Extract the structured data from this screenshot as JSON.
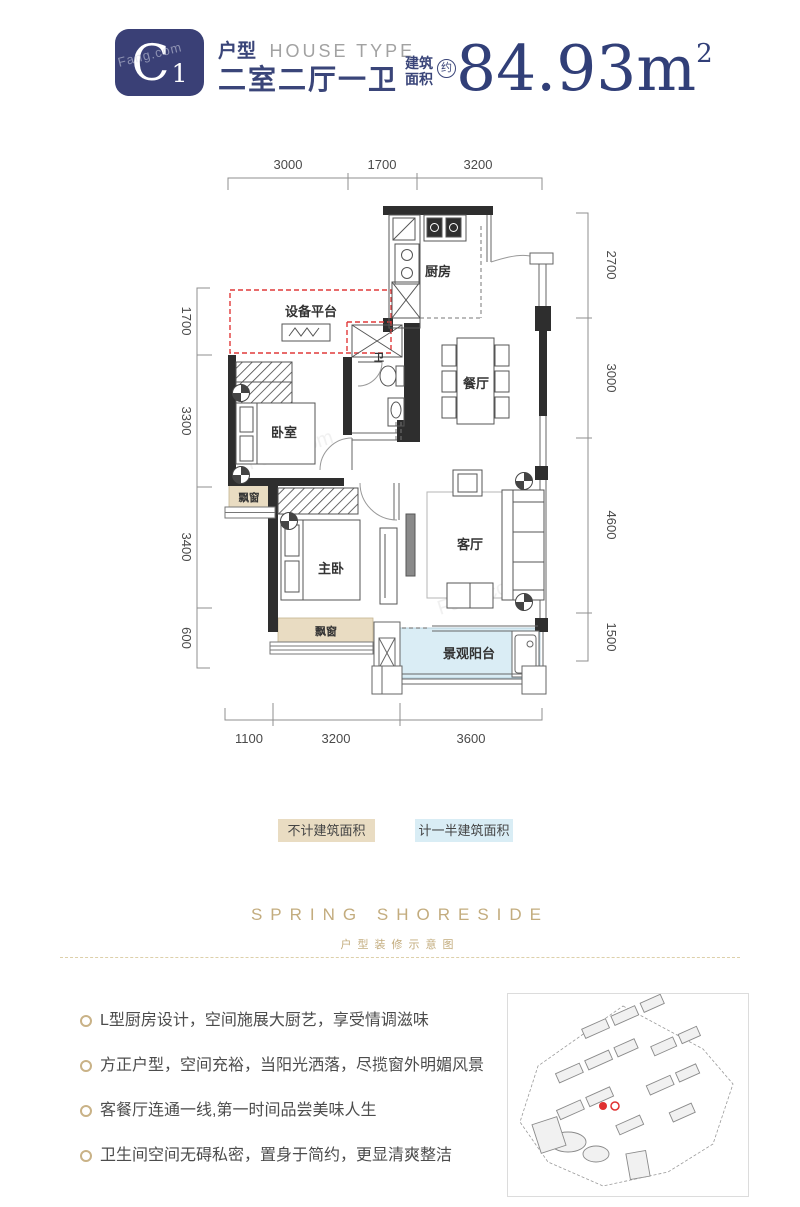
{
  "watermark": "Fang.com",
  "header": {
    "unit_letter": "C",
    "unit_number": "1",
    "label_cn": "户型",
    "label_en": "HOUSE TYPE",
    "layout_name": "二室二厅一卫",
    "area_label_1": "建筑",
    "area_label_2": "面积",
    "area_circle": "约",
    "area_value": "84.93m",
    "area_exponent": "2"
  },
  "floorplan": {
    "rooms": {
      "kitchen": "厨房",
      "equipment_platform": "设备平台",
      "dining": "餐厅",
      "bedroom": "卧室",
      "bay_window_left": "飘窗",
      "master_bedroom": "主卧",
      "living": "客厅",
      "bay_window_bottom": "飘窗",
      "balcony": "景观阳台",
      "bathroom": "卫"
    },
    "dims_top": [
      "3000",
      "1700",
      "3200"
    ],
    "dims_right": [
      "2700",
      "3000",
      "4600",
      "1500"
    ],
    "dims_left": [
      "1700",
      "3300",
      "3400",
      "600"
    ],
    "dims_bottom": [
      "1100",
      "3200",
      "3600"
    ]
  },
  "legend": {
    "excluded": "不计建筑面积",
    "half": "计一半建筑面积"
  },
  "branding": {
    "title": "SPRING SHORESIDE",
    "subtitle": "户型装修示意图"
  },
  "features": [
    "L型厨房设计，空间施展大厨艺，享受情调滋味",
    "方正户型，空间充裕，当阳光洒落，尽揽窗外明媚风景",
    "客餐厅连通一线,第一时间品尝美味人生",
    "卫生间空间无碍私密，置身于简约，更显清爽整洁"
  ],
  "colors": {
    "navy": "#3a4579",
    "gold": "#c3ac7e",
    "tan": "#e9dcc2",
    "light_blue": "#daedf5",
    "red": "#e03a3a"
  }
}
